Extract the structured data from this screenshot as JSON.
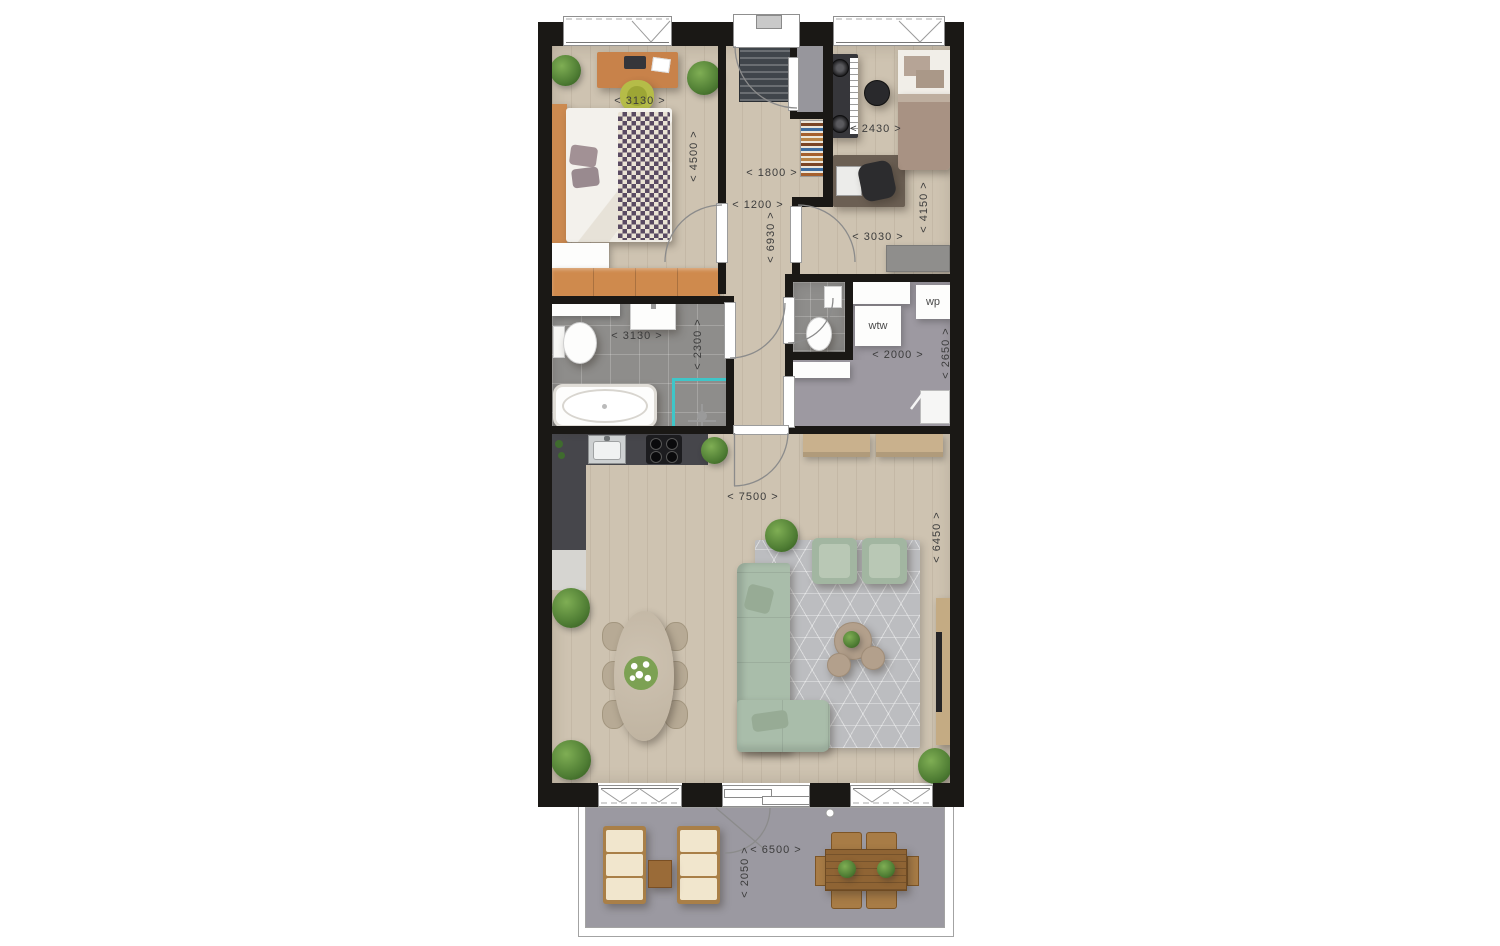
{
  "dimensions_mm": {
    "bedroom1_width": "< 3130 >",
    "bedroom1_depth": "< 4500 >",
    "hall_width_upper": "< 1800 >",
    "hall_width_lower": "< 1200 >",
    "hall_length": "< 6930 >",
    "bedroom2_width": "< 2430 >",
    "bedroom2_depth": "< 4150 >",
    "bedroom2_width_lower": "< 3030 >",
    "bathroom_width": "< 3130 >",
    "bathroom_depth": "< 2300 >",
    "utility_width": "< 2000 >",
    "utility_depth": "< 2650 >",
    "living_width": "< 7500 >",
    "living_depth": "< 6450 >",
    "balcony_width": "< 6500 >",
    "balcony_depth": "< 2050 >"
  },
  "equipment_labels": {
    "heat_recovery_unit": "wtw",
    "heat_pump": "wp"
  },
  "colors": {
    "wall": "#1a1815",
    "wood_floor": "#cec3b1",
    "bathroom_tile": "#8e8d8b",
    "utility_floor": "#9d99a1",
    "balcony_floor": "#9b99a1",
    "kitchen_counter": "#46464b",
    "sofa_green": "#a9bdaa",
    "shower_accent_teal": "#3fc6c8",
    "furniture_wood_orange": "#cd8a4e",
    "rug_gray": "#bcbdc0",
    "dimension_text": "#3c3c3c"
  }
}
